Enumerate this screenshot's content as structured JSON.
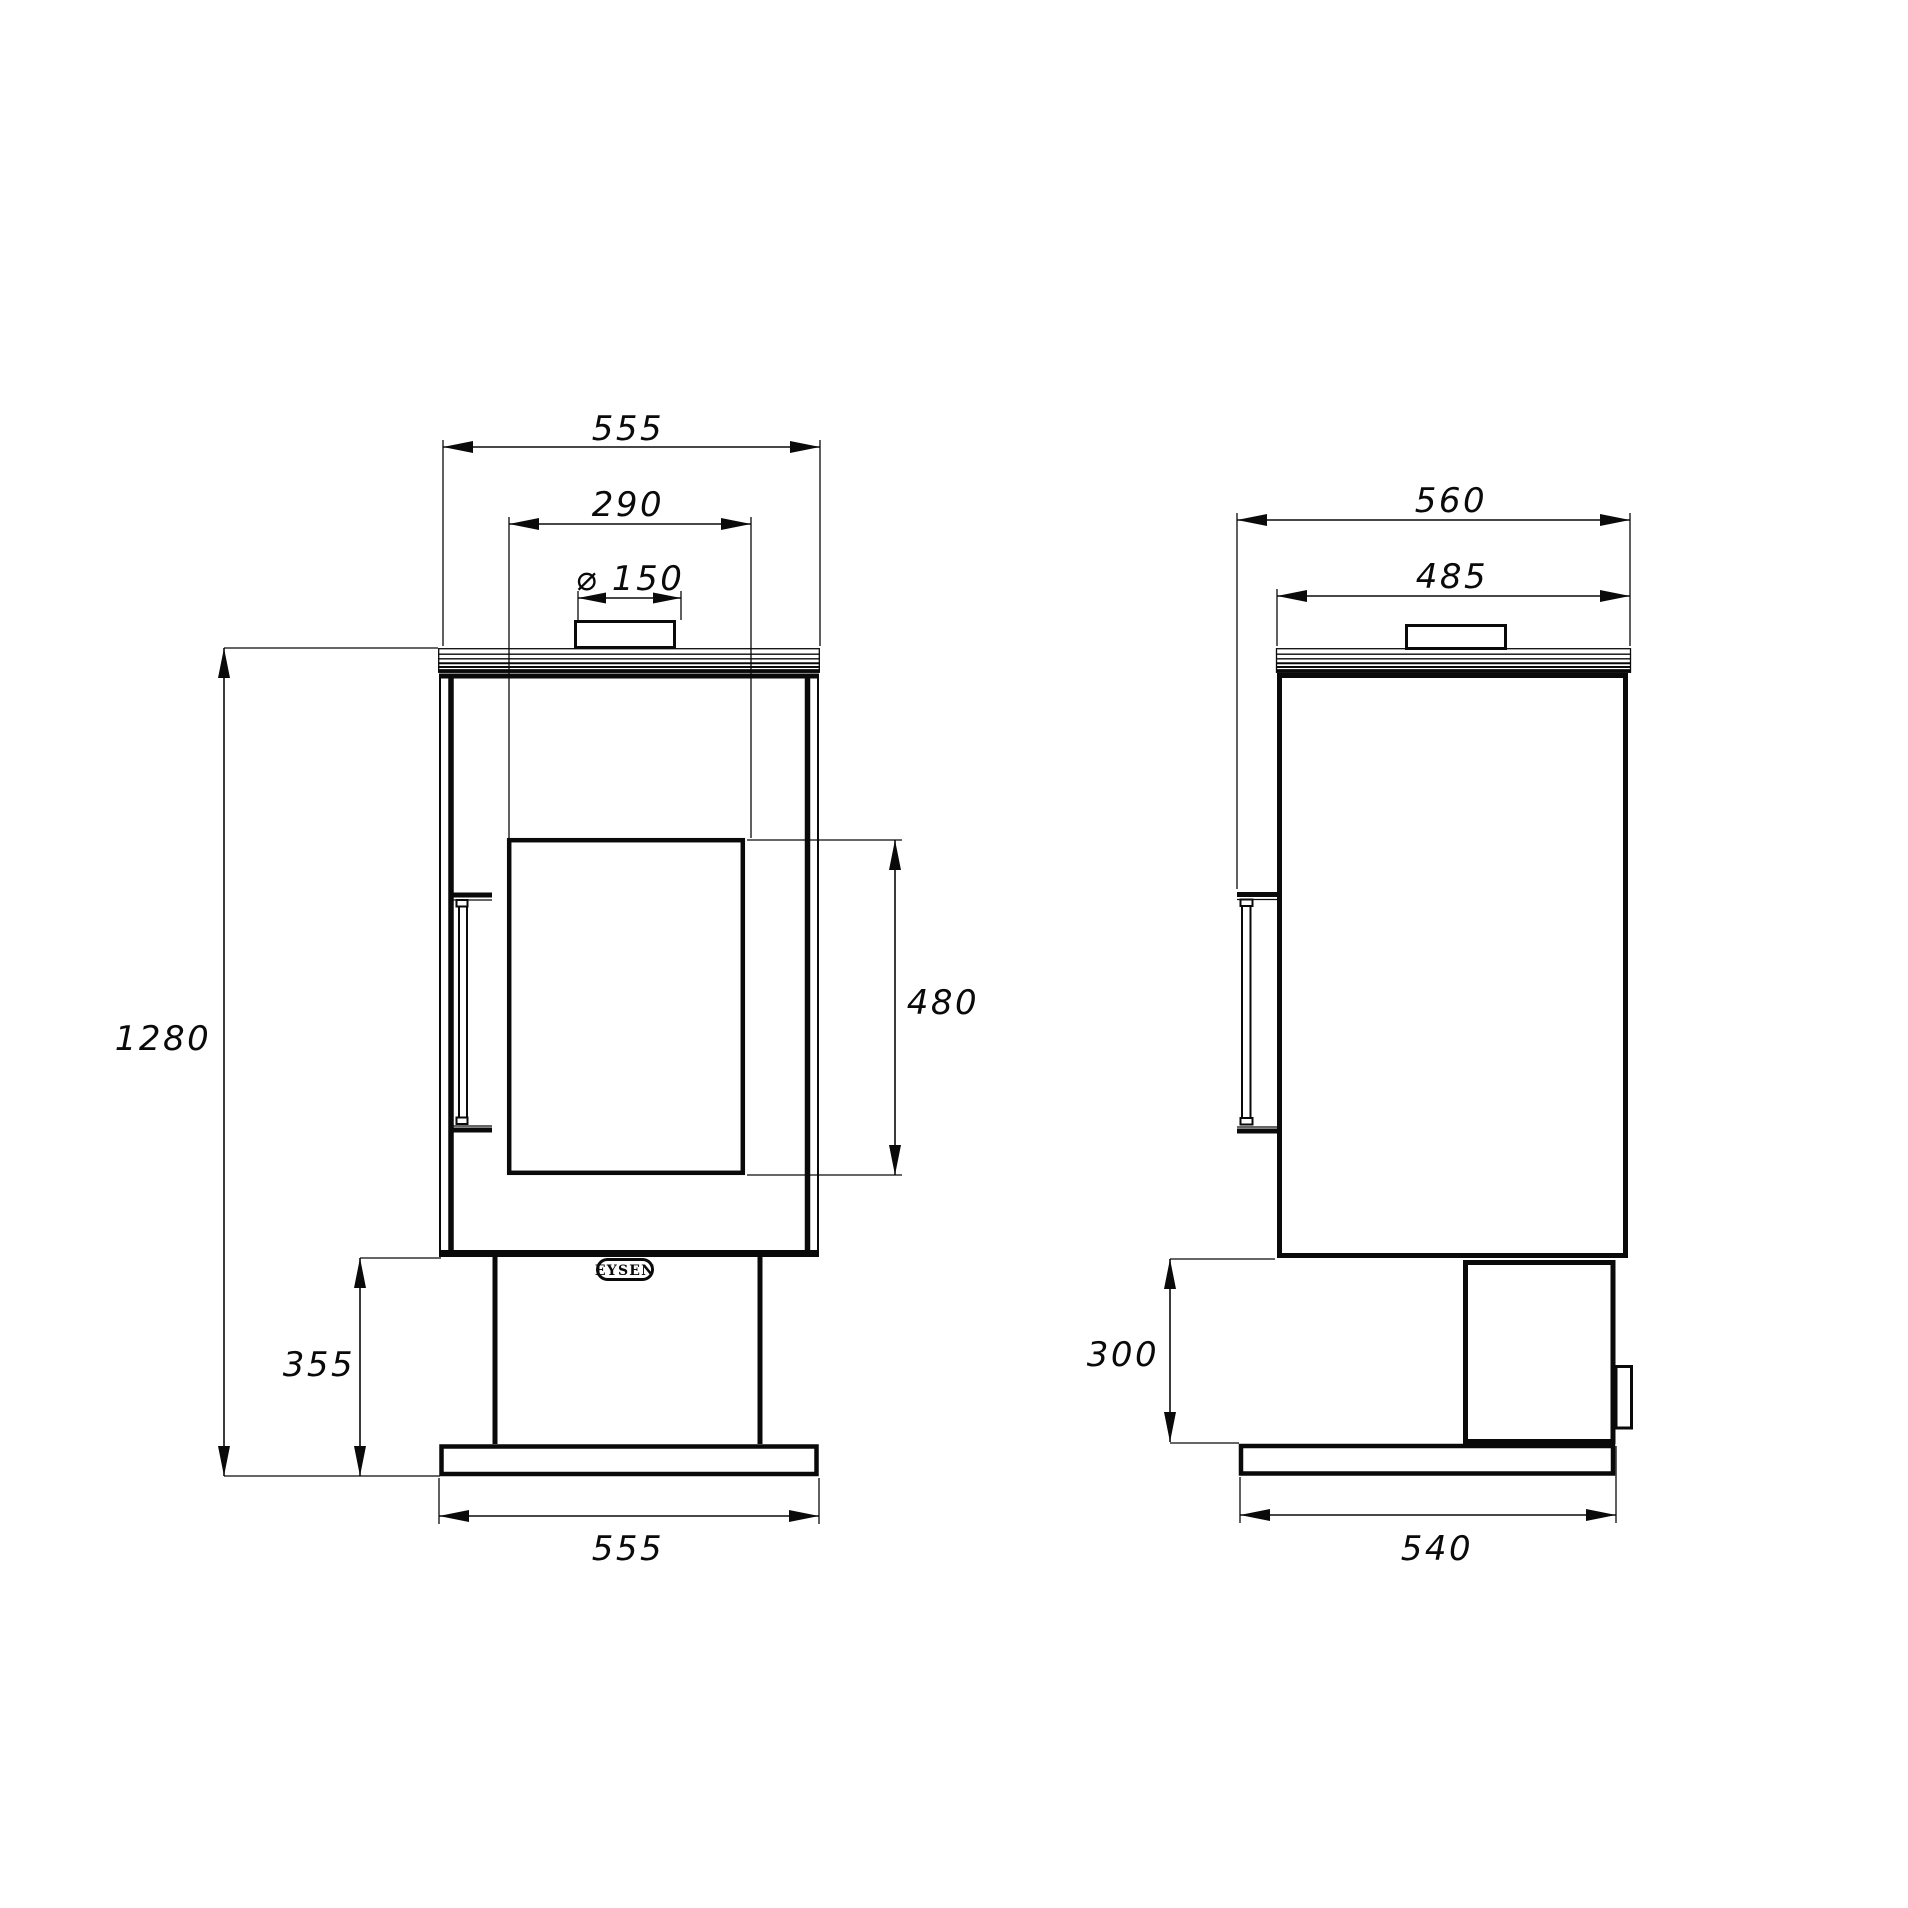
{
  "front": {
    "dim_top_width": "555",
    "dim_glass_width": "290",
    "dim_flue_diameter": "⌀ 150",
    "dim_overall_height": "1280",
    "dim_glass_height": "480",
    "dim_base_height": "355",
    "dim_base_width": "555",
    "logo": "EYSEN"
  },
  "side": {
    "dim_overall_depth": "560",
    "dim_body_depth": "485",
    "dim_base_height": "300",
    "dim_base_depth": "540"
  }
}
